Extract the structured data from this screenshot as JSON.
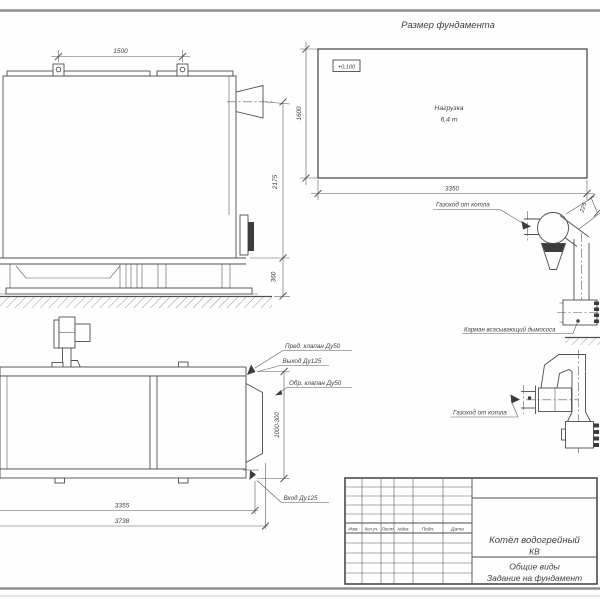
{
  "foundation_plan": {
    "title": "Размер фундамента",
    "level_mark": "+0,100",
    "load_label": "Нагрузка",
    "load_value": "6,4 т",
    "dim_width": "3350",
    "dim_height": "1600"
  },
  "side_view": {
    "dim_lug_spacing": "1500",
    "dim_height": "2175",
    "dim_base_height": "360"
  },
  "flue_upper": {
    "label_flue": "Газоход от котла",
    "dim_offset": "225",
    "label_pocket": "Карман всасывающий дымососа"
  },
  "flue_lower": {
    "label_flue": "Газоход от котла"
  },
  "plan_view": {
    "label_safety_valve": "Пред. клапан Ду50",
    "label_outlet": "Выход Ду125",
    "label_check_valve": "Обр. клапан Ду50",
    "label_inlet": "Вход Ду125",
    "dim_length_inner": "3355",
    "dim_length_outer": "3738",
    "dim_depth": "1000-300"
  },
  "title_block": {
    "columns": [
      "Изм.",
      "Кол.уч.",
      "Лист",
      "№док.",
      "Подп.",
      "Дата"
    ],
    "product_line1": "Котёл водогрейный",
    "product_line2": "КВ",
    "doc_line1": "Общие виды",
    "doc_line2": "Задание на фундамент"
  }
}
